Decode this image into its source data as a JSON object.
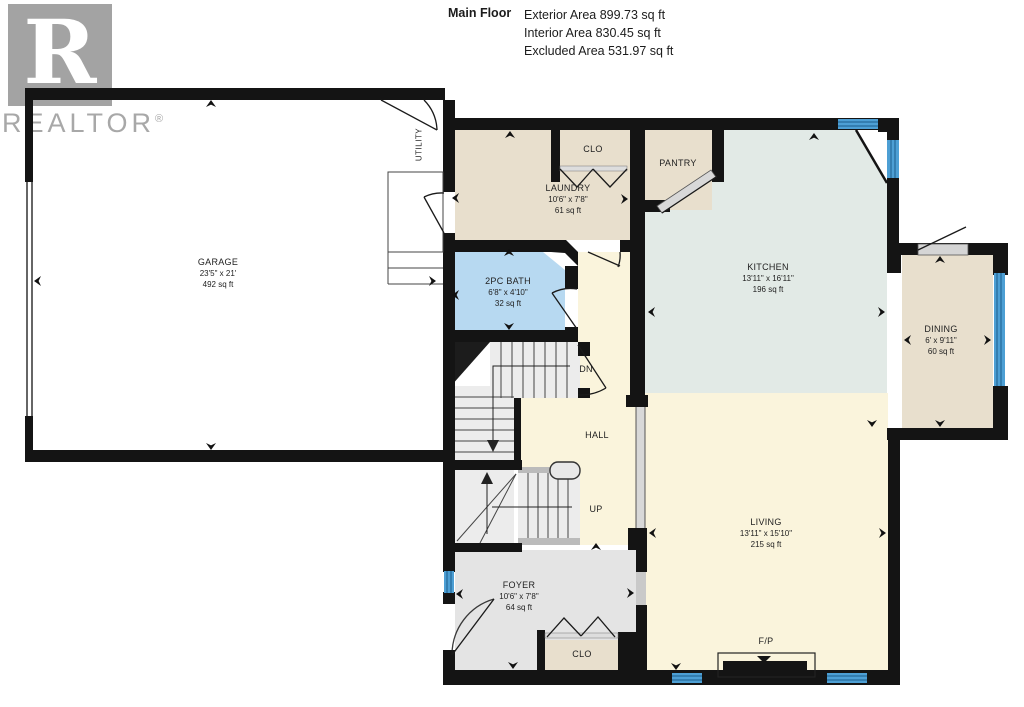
{
  "header": {
    "title": "Main Floor",
    "lines": [
      "Exterior Area 899.73 sq ft",
      "Interior Area 830.45 sq ft",
      "Excluded Area 531.97 sq ft"
    ]
  },
  "logo": {
    "letter": "R",
    "text": "REALTOR",
    "registered": "®"
  },
  "rooms": {
    "garage": {
      "name": "GARAGE",
      "dims": "23'5\" x 21'",
      "area": "492 sq ft"
    },
    "laundry": {
      "name": "LAUNDRY",
      "dims": "10'6\" x 7'8\"",
      "area": "61 sq ft"
    },
    "bath": {
      "name": "2PC BATH",
      "dims": "6'8\" x 4'10\"",
      "area": "32 sq ft"
    },
    "kitchen": {
      "name": "KITCHEN",
      "dims": "13'11\" x 16'11\"",
      "area": "196 sq ft"
    },
    "dining": {
      "name": "DINING",
      "dims": "6' x 9'11\"",
      "area": "60 sq ft"
    },
    "living": {
      "name": "LIVING",
      "dims": "13'11\" x 15'10\"",
      "area": "215 sq ft"
    },
    "foyer": {
      "name": "FOYER",
      "dims": "10'6\" x 7'8\"",
      "area": "64 sq ft"
    }
  },
  "labels": {
    "pantry": "PANTRY",
    "closet_laundry": "CLO",
    "closet_foyer": "CLO",
    "hall": "HALL",
    "up": "UP",
    "dn": "DN",
    "utility": "UTILITY",
    "fireplace": "F/P"
  },
  "colors": {
    "wall": "#141414",
    "room_beige": "#e8dfcd",
    "room_kitchen": "#e2eae6",
    "room_cream": "#faf4dc",
    "room_bath": "#b7d9f1",
    "room_gray": "#e4e4e4",
    "stairs": "#ececec",
    "window_blue": "#4d9fd4",
    "logo_gray": "#a3a3a3"
  }
}
